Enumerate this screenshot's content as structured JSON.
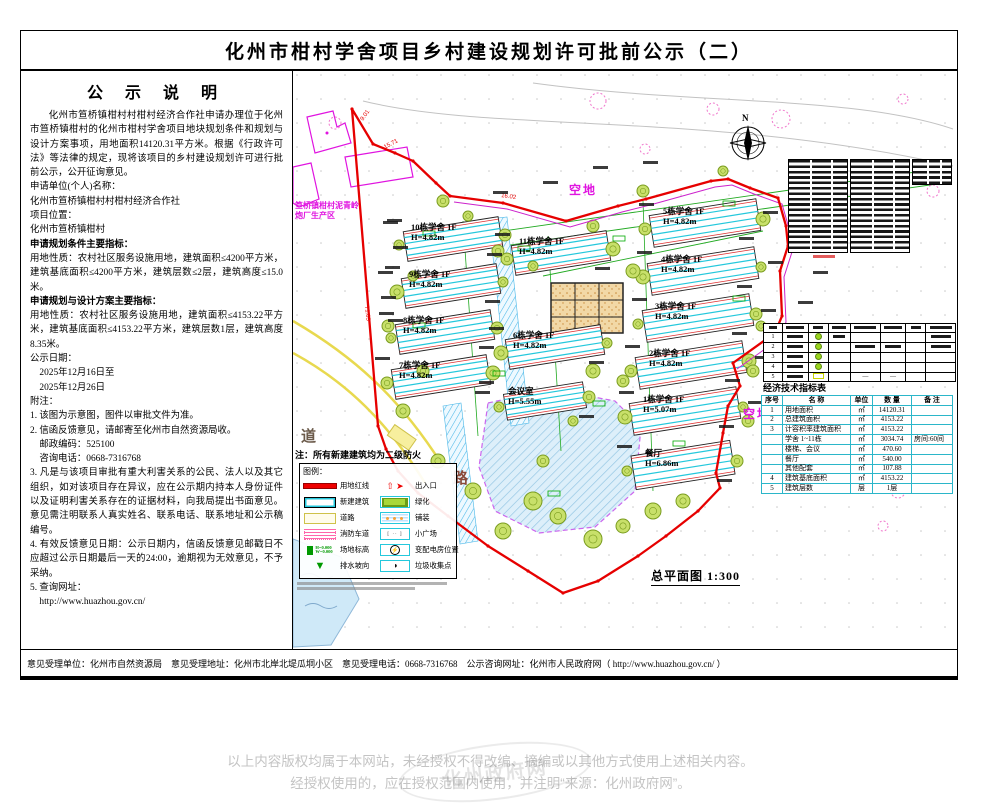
{
  "page_title": "化州市柑村学舍项目乡村建设规划许可批前公示（二）",
  "notice": {
    "heading": "公 示 说 明",
    "lines": [
      {
        "t": "化州市笪桥镇柑村村柑村经济合作社申请办理位于化州市笪桥镇柑村的化州市柑村学舍项目地块规划条件和规划与设计方案事项，用地面积14120.31平方米。根据《行政许可法》等法律的规定，现将该项目的乡村建设规划许可进行批前公示，公开征询意见。",
        "style": "indent"
      },
      {
        "t": "申请单位(个人)名称：",
        "style": ""
      },
      {
        "t": "化州市笪桥镇柑村村柑村经济合作社",
        "style": ""
      },
      {
        "t": "项目位置：",
        "style": ""
      },
      {
        "t": "化州市笪桥镇柑村",
        "style": ""
      },
      {
        "t": "申请规划条件主要指标：",
        "style": "bold"
      },
      {
        "t": "用地性质：农村社区服务设施用地，建筑面积≤4200平方米，建筑基底面积≤4200平方米，建筑层数≤2层，建筑高度≤15.0米。",
        "style": ""
      },
      {
        "t": "申请规划与设计方案主要指标：",
        "style": "bold"
      },
      {
        "t": "用地性质：农村社区服务设施用地，建筑面积≤4153.22平方米，建筑基底面积≤4153.22平方米，建筑层数1层，建筑高度8.35米。",
        "style": ""
      },
      {
        "t": "公示日期：",
        "style": ""
      },
      {
        "t": "　2025年12月16日至",
        "style": ""
      },
      {
        "t": "　2025年12月26日",
        "style": ""
      },
      {
        "t": "附注：",
        "style": ""
      },
      {
        "t": "1. 该图为示意图，图件以审批文件为准。",
        "style": ""
      },
      {
        "t": "2. 信函反馈意见，请邮寄至化州市自然资源局收。",
        "style": ""
      },
      {
        "t": "　邮政编码：525100",
        "style": ""
      },
      {
        "t": "　咨询电话：0668-7316768",
        "style": ""
      },
      {
        "t": "3. 凡是与该项目审批有重大利害关系的公民、法人以及其它组织，如对该项目存在异议，应在公示期内持本人身份证件以及证明利害关系存在的证据材料，向我局提出书面意见。意见需注明联系人真实姓名、联系电话、联系地址和公示稿编号。",
        "style": ""
      },
      {
        "t": "4. 有效反馈意见日期：公示日期内，信函反馈意见邮戳日不应超过公示日期最后一天的24:00，逾期视为无效意见，不予采纳。",
        "style": ""
      },
      {
        "t": "5. 查询网址：",
        "style": ""
      },
      {
        "t": "　http://www.huazhou.gov.cn/",
        "style": ""
      }
    ]
  },
  "map": {
    "north_label": "N",
    "scale_label": "总平面图 1:300",
    "fire_note": "注：所有新建建筑均为二级防火",
    "open_land_1": "空地",
    "open_land_2": "空地",
    "road_char_1": "道",
    "road_char_2": "路",
    "area_label_line1": "笪桥镇柑村泥青岭",
    "area_label_line2": "炮厂生产区",
    "boundary_dims": [
      "9.01",
      "15.71",
      "16.02",
      "71.63"
    ],
    "buildings": [
      {
        "name": "10栋学舍 1F",
        "h": "H=4.82m"
      },
      {
        "name": "11栋学舍 1F",
        "h": "H=4.82m"
      },
      {
        "name": "9栋学舍 1F",
        "h": "H=4.82m"
      },
      {
        "name": "8栋学舍 1F",
        "h": "H=4.82m"
      },
      {
        "name": "7栋学舍 1F",
        "h": "H=4.82m"
      },
      {
        "name": "6栋学舍 1F",
        "h": "H=4.82m"
      },
      {
        "name": "会议室",
        "h": "H=5.55m"
      },
      {
        "name": "5栋学舍 1F",
        "h": "H=4.82m"
      },
      {
        "name": "4栋学舍 1F",
        "h": "H=4.82m"
      },
      {
        "name": "3栋学舍 1F",
        "h": "H=4.82m"
      },
      {
        "name": "2栋学舍 1F",
        "h": "H=4.82m"
      },
      {
        "name": "1栋学舍 1F",
        "h": "H=5.07m"
      },
      {
        "name": "餐厅",
        "h": "H=6.86m"
      }
    ],
    "legend": {
      "title": "图例：",
      "left": [
        {
          "label": "用地红线",
          "type": "redline"
        },
        {
          "label": "新建建筑",
          "type": "building"
        },
        {
          "label": "道路",
          "type": "road"
        },
        {
          "label": "消防车道",
          "type": "firelane"
        },
        {
          "label": "场地标高",
          "type": "elev"
        },
        {
          "label": "排水坡向",
          "type": "slope"
        }
      ],
      "right": [
        {
          "label": "出入口",
          "type": "entrance"
        },
        {
          "label": "绿化",
          "type": "green"
        },
        {
          "label": "铺装",
          "type": "paving"
        },
        {
          "label": "小广场",
          "type": "plaza"
        },
        {
          "label": "变配电房位置",
          "type": "power"
        },
        {
          "label": "垃圾收集点",
          "type": "trash"
        }
      ]
    },
    "indicator_table": {
      "title": "经济技术指标表",
      "headers": [
        "序号",
        "名  称",
        "单位",
        "数 量",
        "备 注"
      ],
      "rows": [
        [
          "1",
          "用地面积",
          "㎡",
          "14120.31",
          ""
        ],
        [
          "2",
          "总建筑面积",
          "㎡",
          "4153.22",
          ""
        ],
        [
          "3",
          "计容积率建筑面积",
          "㎡",
          "4153.22",
          ""
        ],
        [
          "",
          "学舍 1~11栋",
          "㎡",
          "3034.74",
          "房间:60间"
        ],
        [
          "",
          "楼梯、会议",
          "㎡",
          "470.60",
          ""
        ],
        [
          "",
          "餐厅",
          "㎡",
          "540.00",
          ""
        ],
        [
          "",
          "其他配套",
          "㎡",
          "107.88",
          ""
        ],
        [
          "4",
          "建筑基底面积",
          "㎡",
          "4153.22",
          ""
        ],
        [
          "5",
          "建筑层数",
          "层",
          "1层",
          ""
        ]
      ]
    },
    "plant_table": {
      "row_numbers": [
        "1",
        "2",
        "3",
        "4",
        "5"
      ]
    }
  },
  "footer_bar": {
    "text": "意见受理单位：化州市自然资源局　意见受理地址：化州市北岸北堤瓜垌小区　意见受理电话：0668-7316768　公示咨询网址：化州市人民政府网（ http://www.huazhou.gov.cn/ ）"
  },
  "copyright": {
    "line1": "以上内容版权均属于本网站，未经授权不得改编、摘编或以其他方式使用上述相关内容。",
    "line2": "经授权使用的，应在授权范围内使用，并注明“来源：化州政府网”。",
    "watermark": "化州政府网"
  },
  "colors": {
    "boundary_red": "#e60000",
    "parcel_magenta": "#cc22cc",
    "survey_green": "#22aa22",
    "grid_cyan": "#2bb6c9",
    "road_yellow": "#e8d94f",
    "water_blue": "#cfe9f8",
    "tree_fill": "#c8e06a",
    "tree_stroke": "#7a9c1f",
    "magenta_text": "#e014e0"
  }
}
